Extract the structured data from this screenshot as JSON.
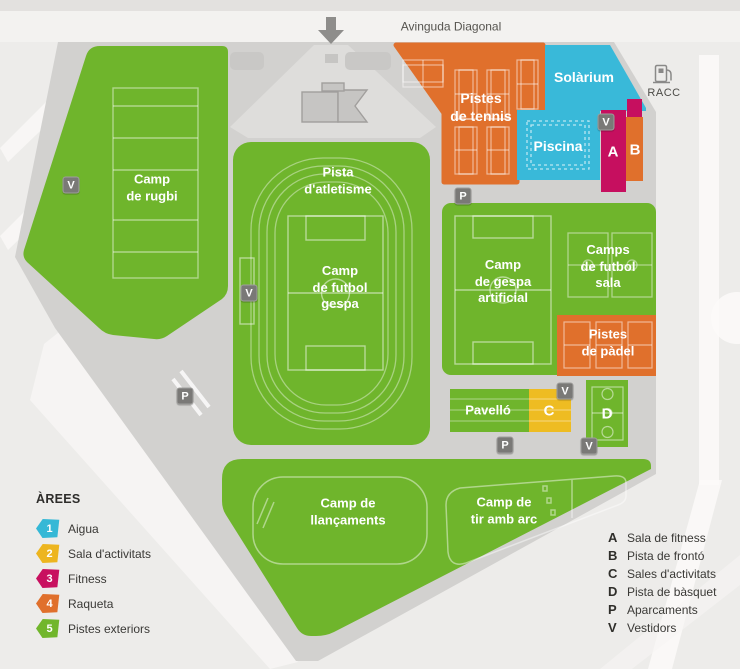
{
  "header": {
    "street": "Avinguda Diagonal"
  },
  "landmark": {
    "racc": "RACC"
  },
  "fields": {
    "rugbi": "Camp\nde rugbi",
    "atletisme": "Pista\nd'atletisme",
    "futbol_gespa": "Camp\nde futbol\ngespa",
    "tennis": "Pistes\nde tennis",
    "solarium": "Solàrium",
    "piscina": "Piscina",
    "gespa_artificial": "Camp\nde gespa\nartificial",
    "futbol_sala": "Camps\nde futbol\nsala",
    "padel": "Pistes\nde pàdel",
    "pavello": "Pavelló",
    "llancaments": "Camp de\nllançaments",
    "tir_amb_arc": "Camp de\ntir amb arc"
  },
  "buildings": {
    "a": "A",
    "b": "B",
    "c": "C",
    "d": "D"
  },
  "badges": {
    "v": "V",
    "p": "P"
  },
  "legend_areas": {
    "title": "ÀREES",
    "items": [
      {
        "num": "1",
        "label": "Aigua",
        "color": "#35b8d6"
      },
      {
        "num": "2",
        "label": "Sala d'activitats",
        "color": "#edb51f"
      },
      {
        "num": "3",
        "label": "Fitness",
        "color": "#c8105f"
      },
      {
        "num": "4",
        "label": "Raqueta",
        "color": "#e0702c"
      },
      {
        "num": "5",
        "label": "Pistes exteriors",
        "color": "#71b62c"
      }
    ]
  },
  "legend_keys": {
    "items": [
      {
        "key": "A",
        "label": "Sala de fitness"
      },
      {
        "key": "B",
        "label": "Pista de frontó"
      },
      {
        "key": "C",
        "label": "Sales d'activitats"
      },
      {
        "key": "D",
        "label": "Pista de bàsquet"
      },
      {
        "key": "P",
        "label": "Aparcaments"
      },
      {
        "key": "V",
        "label": "Vestidors"
      }
    ]
  },
  "colors": {
    "green": "#6fb52c",
    "orange": "#e0702c",
    "cyan": "#39b9d9",
    "magenta": "#c60f5f",
    "yellow": "#eebc22",
    "road": "#d2d1cf",
    "badge_gray": "#7a7977"
  }
}
